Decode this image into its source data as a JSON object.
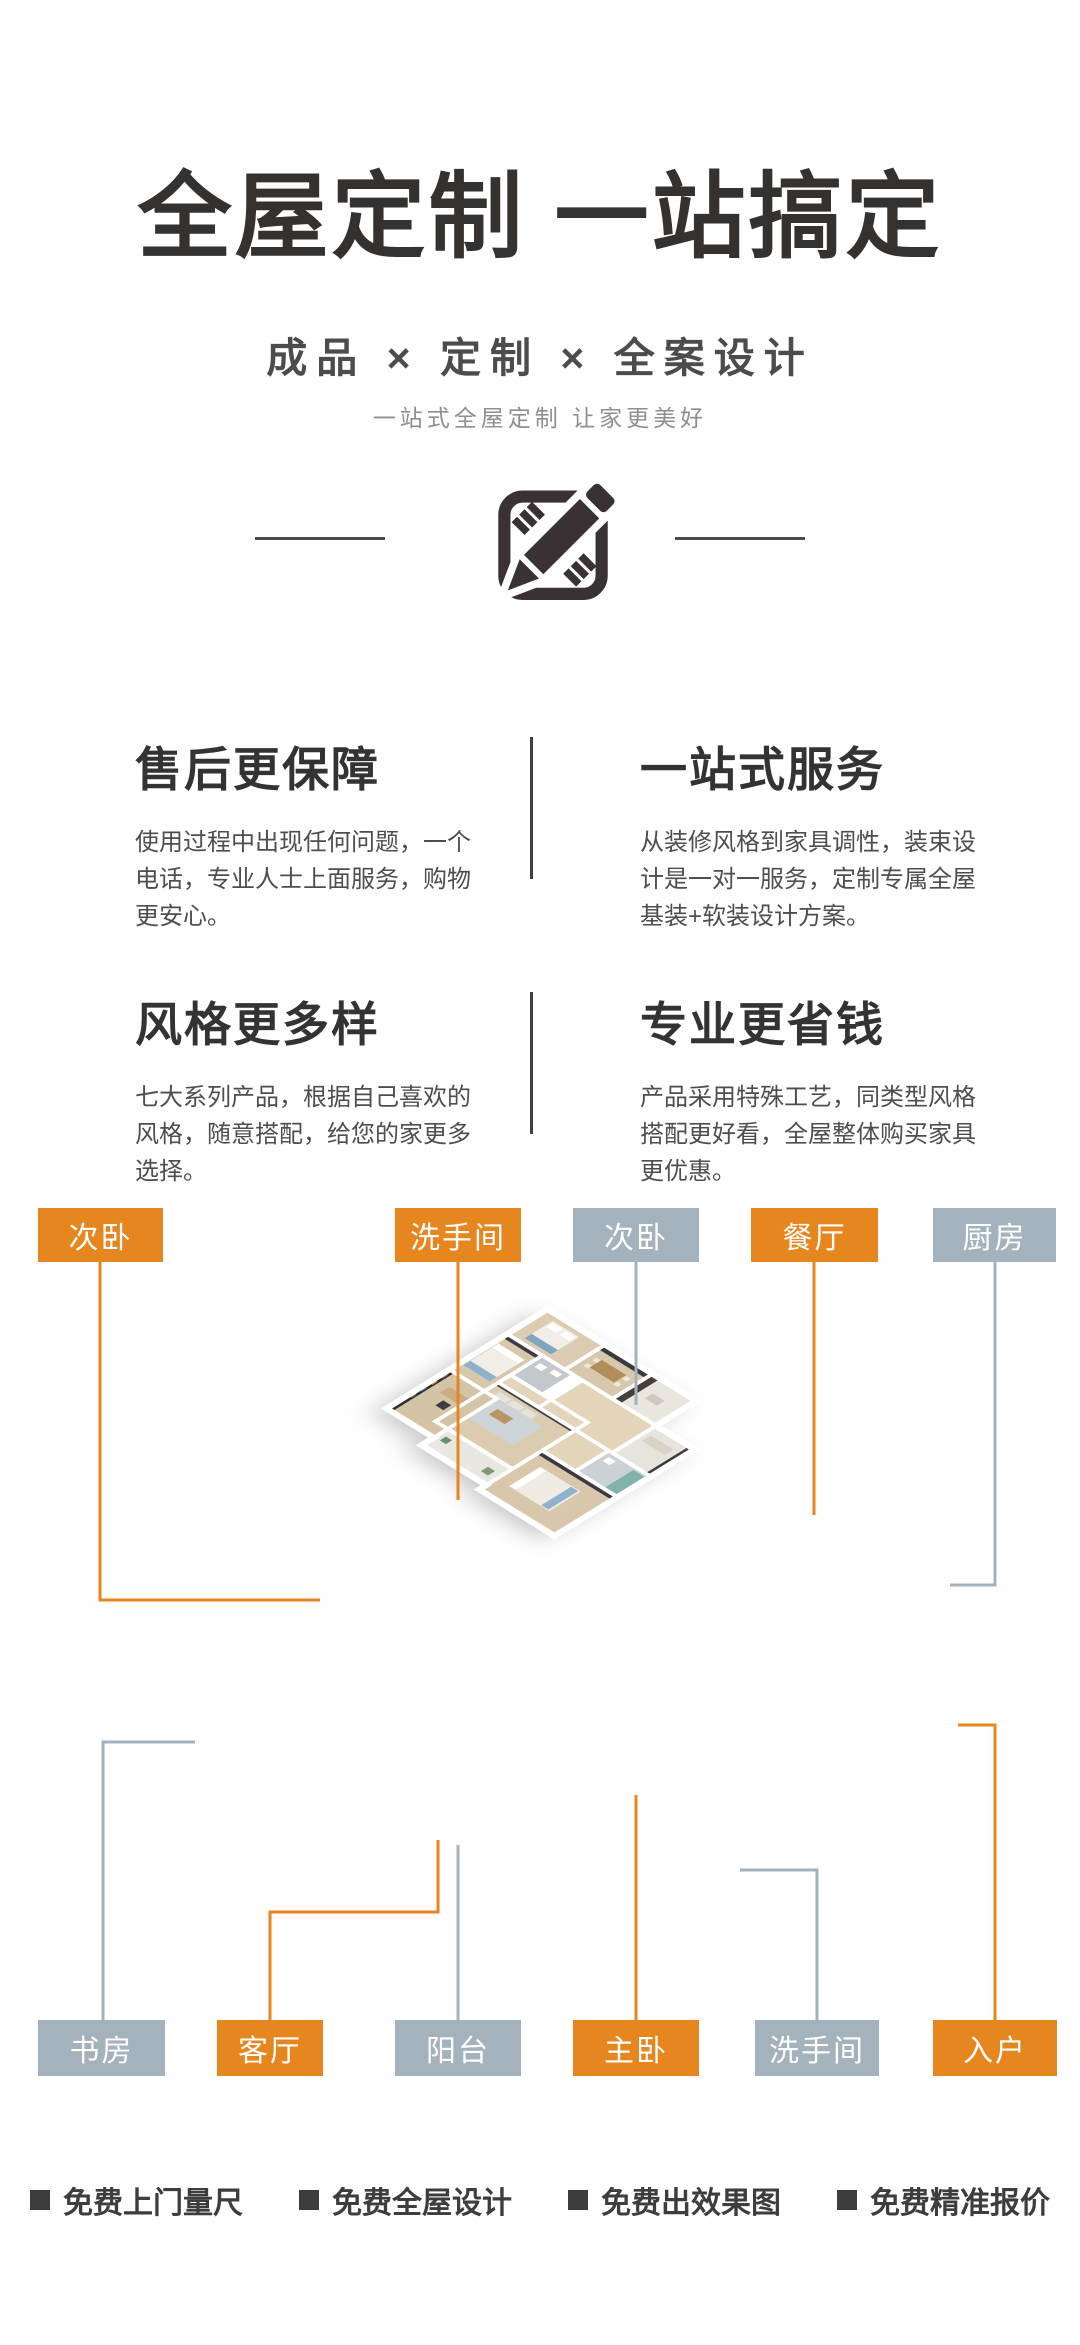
{
  "hero": {
    "title": "全屋定制 一站搞定",
    "subtitle": "成品 × 定制 × 全案设计",
    "tagline": "一站式全屋定制 让家更美好",
    "icon": "pencil-ruler-icon"
  },
  "features": [
    {
      "title": "售后更保障",
      "body": "使用过程中出现任何问题，一个电话，专业人士上面服务，购物更安心。"
    },
    {
      "title": "一站式服务",
      "body": "从装修风格到家具调性，装束设计是一对一服务，定制专属全屋基装+软装设计方案。"
    },
    {
      "title": "风格更多样",
      "body": "七大系列产品，根据自己喜欢的风格，随意搭配，给您的家更多选择。"
    },
    {
      "title": "专业更省钱",
      "body": "产品采用特殊工艺，同类型风格搭配更好看，全屋整体购买家具更优惠。"
    }
  ],
  "floorplan": {
    "top_labels": [
      {
        "text": "次卧",
        "variant": "orange"
      },
      {
        "text": "洗手间",
        "variant": "orange"
      },
      {
        "text": "次卧",
        "variant": "gray"
      },
      {
        "text": "餐厅",
        "variant": "orange"
      },
      {
        "text": "厨房",
        "variant": "gray"
      }
    ],
    "bottom_labels": [
      {
        "text": "书房",
        "variant": "gray"
      },
      {
        "text": "客厅",
        "variant": "orange"
      },
      {
        "text": "阳台",
        "variant": "gray"
      },
      {
        "text": "主卧",
        "variant": "orange"
      },
      {
        "text": "洗手间",
        "variant": "gray"
      },
      {
        "text": "入户",
        "variant": "orange"
      }
    ]
  },
  "footer": {
    "bullet": "■",
    "items": [
      "免费上门量尺",
      "免费全屋设计",
      "免费出效果图",
      "免费精准报价"
    ]
  },
  "colors": {
    "accent_orange": "#E5861E",
    "label_gray": "#A4B2BD",
    "ink": "#35312F",
    "body_text": "#4C4C4C"
  }
}
